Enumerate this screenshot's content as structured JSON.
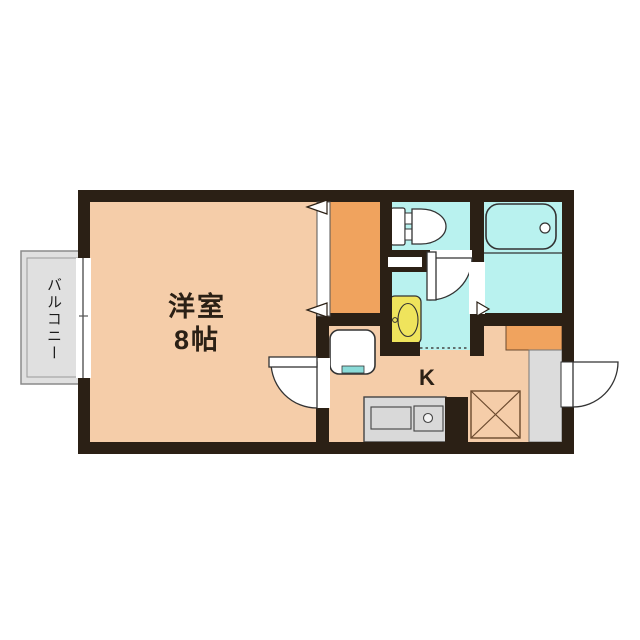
{
  "plan": {
    "room_label_line1": "洋室",
    "room_label_line2": "8帖",
    "kitchen_label": "K",
    "balcony_label": "バルコニー"
  },
  "fixtures": [
    "toilet",
    "bathtub",
    "washbasin",
    "washing-machine-pan",
    "kitchen-counter",
    "kitchen-sink",
    "kitchen-burner",
    "refrigerator-space",
    "shoe-cabinet",
    "entrance-floor",
    "closet",
    "entrance-door",
    "room-door",
    "toilet-door",
    "bathroom-door",
    "window",
    "balcony"
  ],
  "colors": {
    "background": "#ffffff",
    "wall": "#2b2015",
    "floor": "#f5cda9",
    "wet_area": "#b9f2ef",
    "closet": "#f0a35e",
    "basin": "#efe45c",
    "counter": "#d9d9d9",
    "entrance_floor": "#dcdcdc",
    "balcony": "#e0e0e0",
    "appliance_accent": "#8adbd8"
  }
}
